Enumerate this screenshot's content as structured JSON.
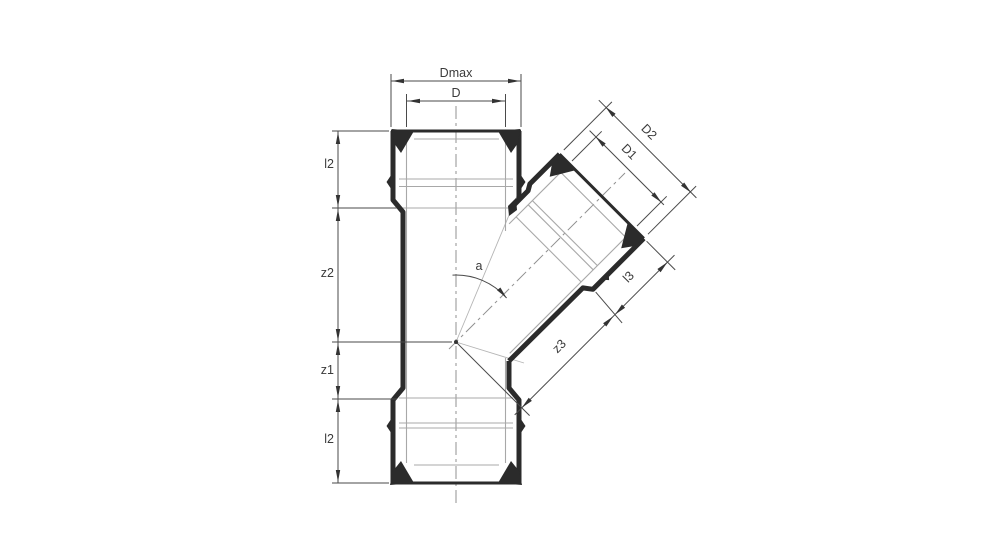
{
  "drawing": {
    "description": "Technical dimension drawing of a 45-degree single branch pipe fitting with push-fit sockets",
    "labels": {
      "dmax": "Dmax",
      "d": "D",
      "d2": "D2",
      "d1": "D1",
      "l2_top": "l2",
      "z2": "z2",
      "z1": "z1",
      "l2_bottom": "l2",
      "l3": "l3",
      "z3": "z3",
      "angle": "a"
    },
    "colors": {
      "background": "#ffffff",
      "outline": "#2b2b2b",
      "thin_line": "#a8a8a8",
      "dimension_line": "#4a4a4a",
      "centerline": "#909090",
      "label_text": "#3a3a3a"
    }
  }
}
